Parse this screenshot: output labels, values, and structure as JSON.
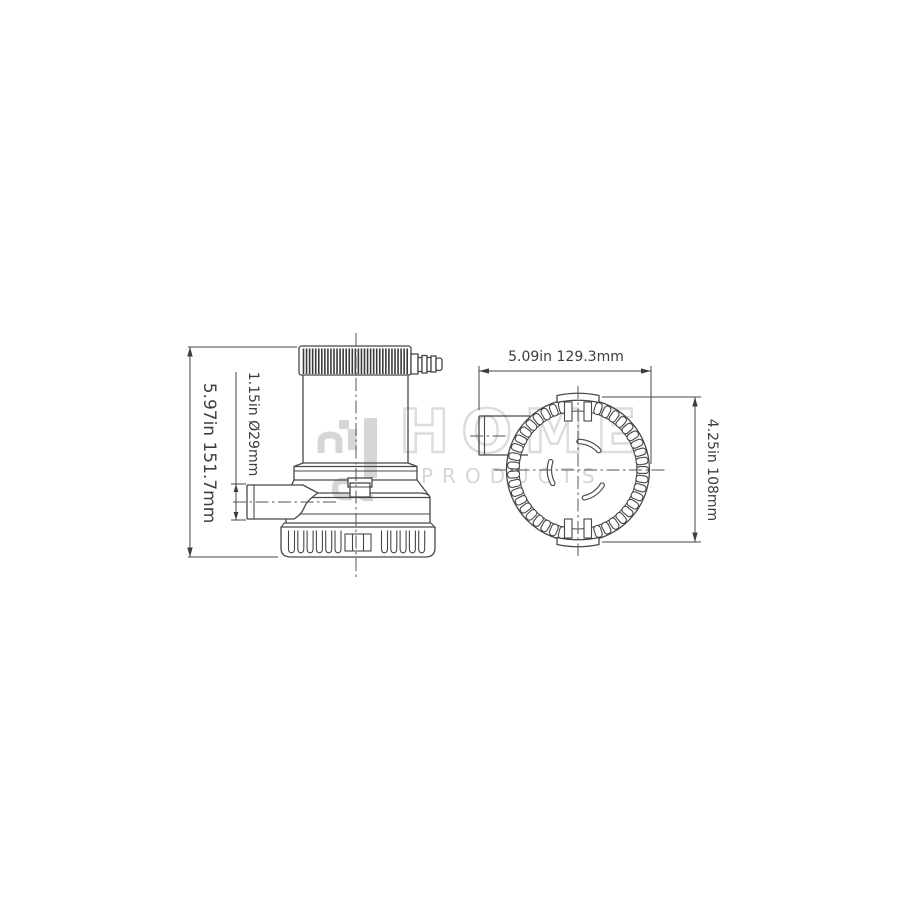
{
  "page": {
    "background": "#ffffff",
    "description": "Two-view dimensioned technical drawing of a marine bilge pump"
  },
  "watermark": {
    "brand": "HOME",
    "brand_line2": "PRODUCTS",
    "outline_color": "#dcdcdc",
    "fill_color": "#d6d6d6"
  },
  "drawing": {
    "line_color": "#474747",
    "centerline_color": "#555555",
    "text_color": "#3d3d3d",
    "views": [
      {
        "id": "side-view",
        "title": "bilge pump side elevation"
      },
      {
        "id": "top-view",
        "title": "bilge pump top view"
      }
    ],
    "dimensions": [
      {
        "id": "overall-height",
        "label": "5.97in 151.7mm",
        "orientation": "vertical"
      },
      {
        "id": "outlet-diameter",
        "label": "1.15in Ø29mm",
        "orientation": "vertical"
      },
      {
        "id": "overall-width",
        "label": "5.09in 129.3mm",
        "orientation": "horizontal"
      },
      {
        "id": "strainer-diameter",
        "label": "4.25in 108mm",
        "orientation": "vertical"
      }
    ]
  }
}
